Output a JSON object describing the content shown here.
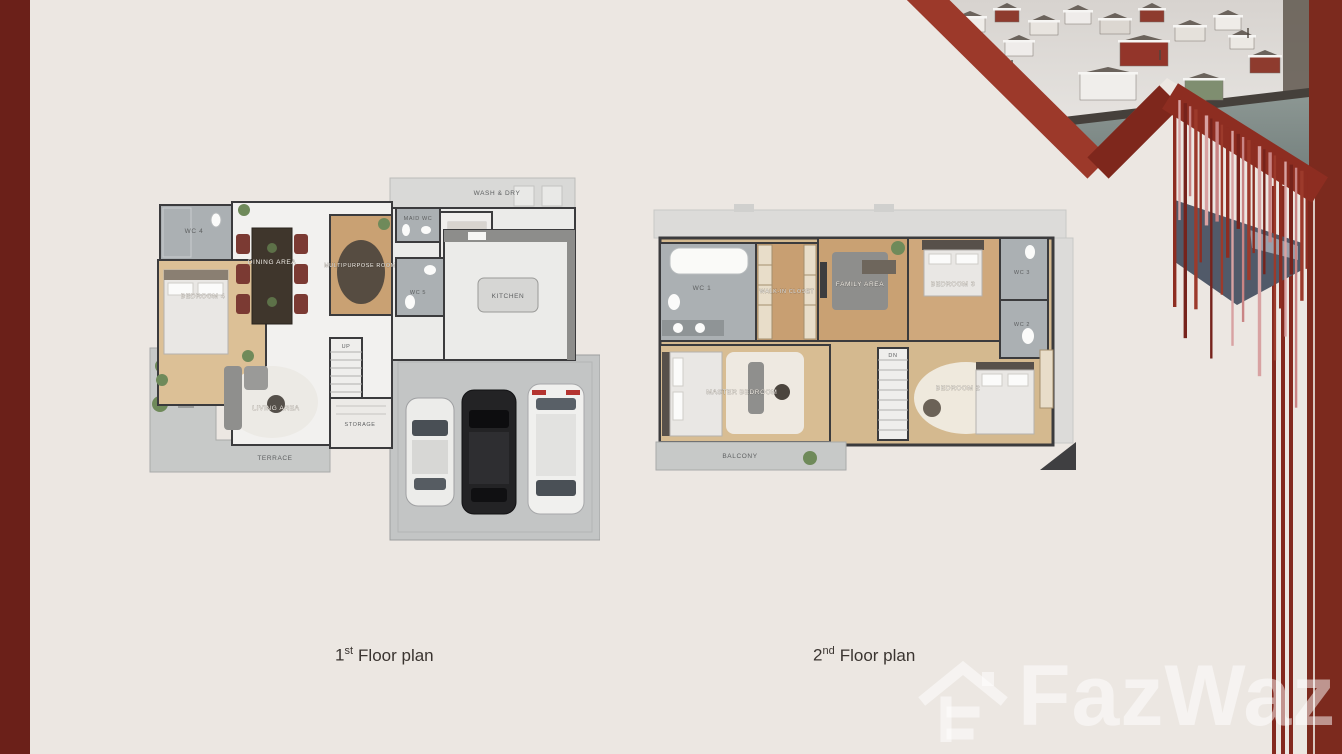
{
  "colors": {
    "background": "#ece7e2",
    "border_red": "#6b2019",
    "accent_red": "#8d2d21",
    "band_red": "#7c2a1e",
    "slate": "#515a69",
    "wood_floor": "#cda87c",
    "tile_gray": "#abb0b3"
  },
  "captions": {
    "floor1": {
      "num": "1",
      "sup": "st",
      "text": "Floor plan"
    },
    "floor2": {
      "num": "2",
      "sup": "nd",
      "text": "Floor plan"
    }
  },
  "floor_plan_1": {
    "rooms": {
      "wash_dry": "WASH & DRY",
      "wc4": "WC 4",
      "maid_wc": "MAID WC",
      "maid": "MAID",
      "wc5": "WC 5",
      "kitchen": "KITCHEN",
      "dining": "DINING AREA",
      "multipurpose": "MULTIPURPOSE ROOM",
      "bedroom": "BEDROOM 4",
      "stairs": "UP",
      "living": "LIVING AREA",
      "storage": "STORAGE",
      "terrace": "TERRACE"
    }
  },
  "floor_plan_2": {
    "rooms": {
      "wc1": "WC 1",
      "walk_in": "WALK-IN CLOSET",
      "family": "FAMILY AREA",
      "bedroom3": "BEDROOM 3",
      "wc3": "WC 3",
      "wc2": "WC 2",
      "master": "MASTER BEDROOM",
      "stairs": "DN",
      "bedroom2": "BEDROOM 2",
      "balcony": "BALCONY"
    }
  },
  "watermark": {
    "brand": "FazWaz"
  }
}
